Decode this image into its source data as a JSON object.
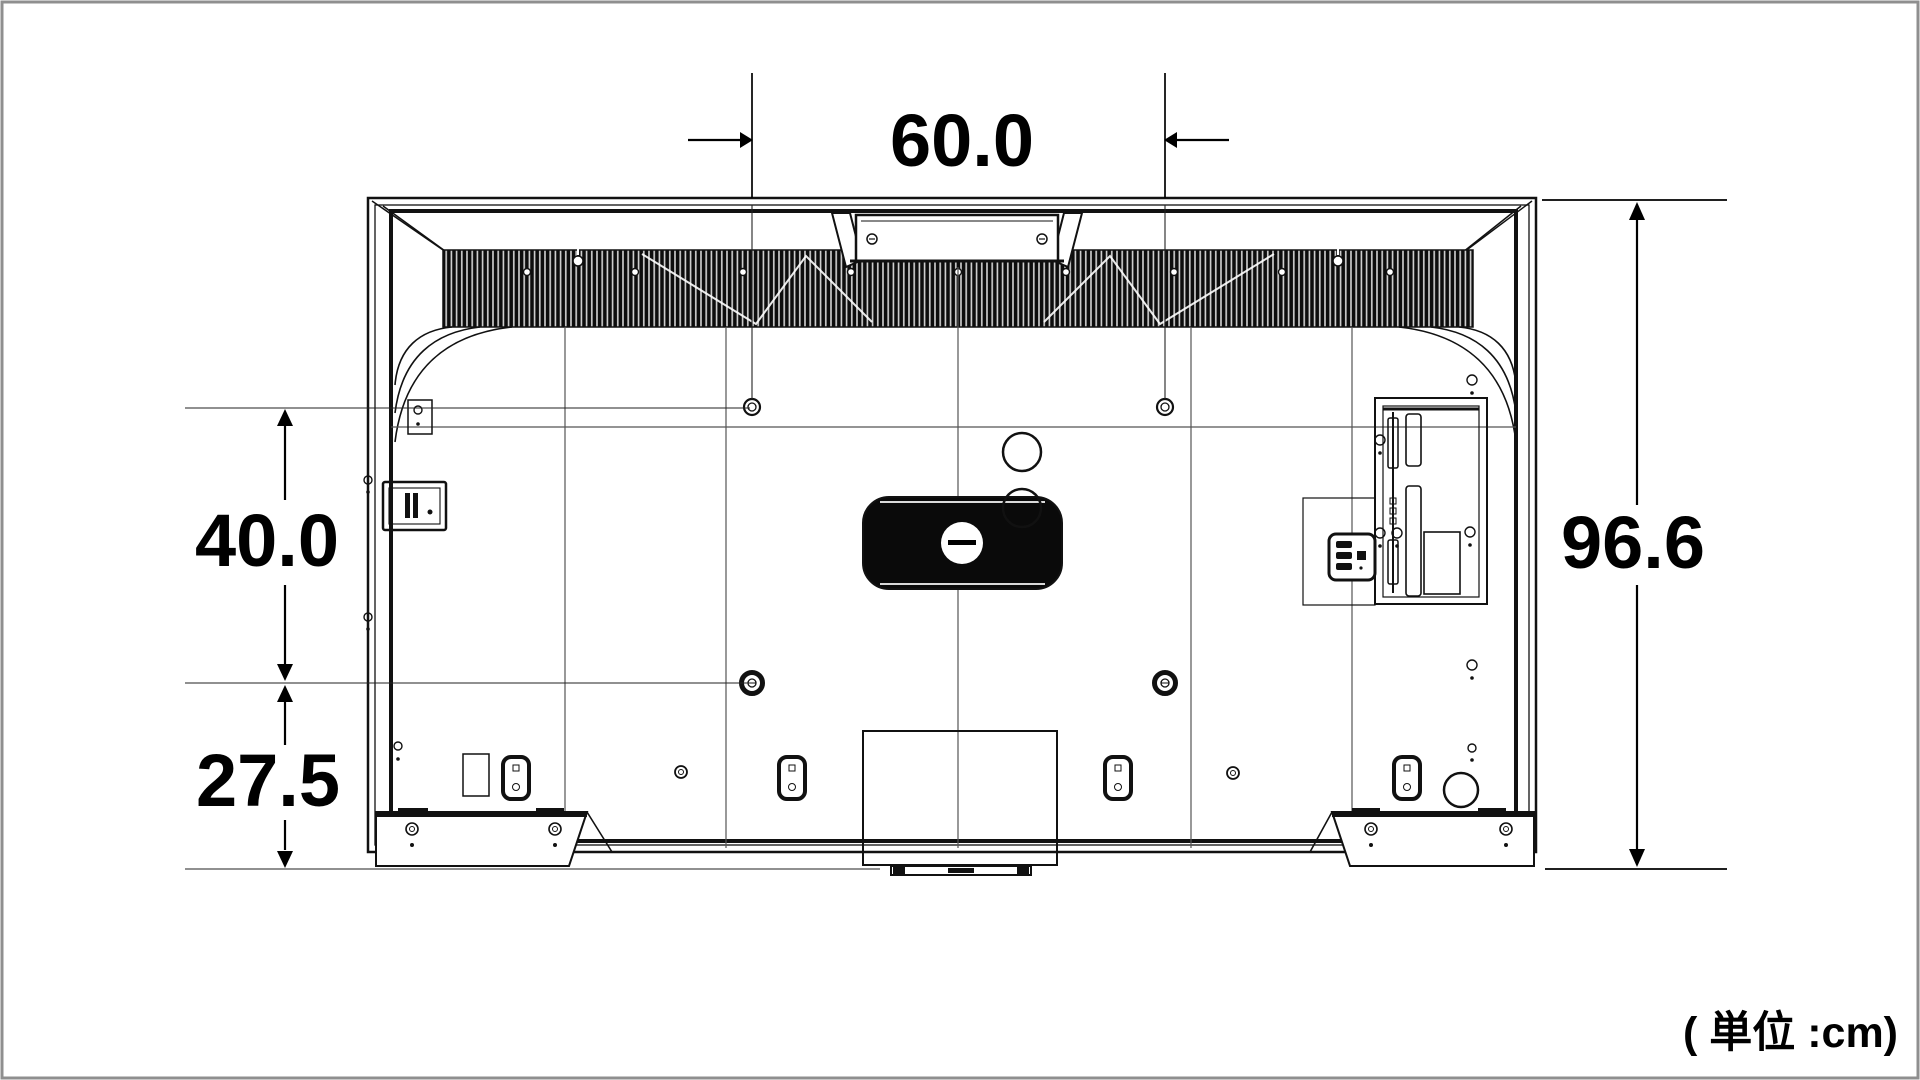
{
  "figure": {
    "type": "technical-dimension-drawing",
    "subject": "television rear view with stand",
    "unit_label": "( 単位 :cm)",
    "dimensions": {
      "vesa_hole_width": "60.0",
      "total_height": "96.6",
      "vesa_hole_height": "40.0",
      "lower_vesa_to_bottom": "27.5"
    },
    "colors": {
      "line": "#111111",
      "seam": "#555555",
      "background": "#ffffff",
      "page_border": "#8f8f8f"
    }
  }
}
